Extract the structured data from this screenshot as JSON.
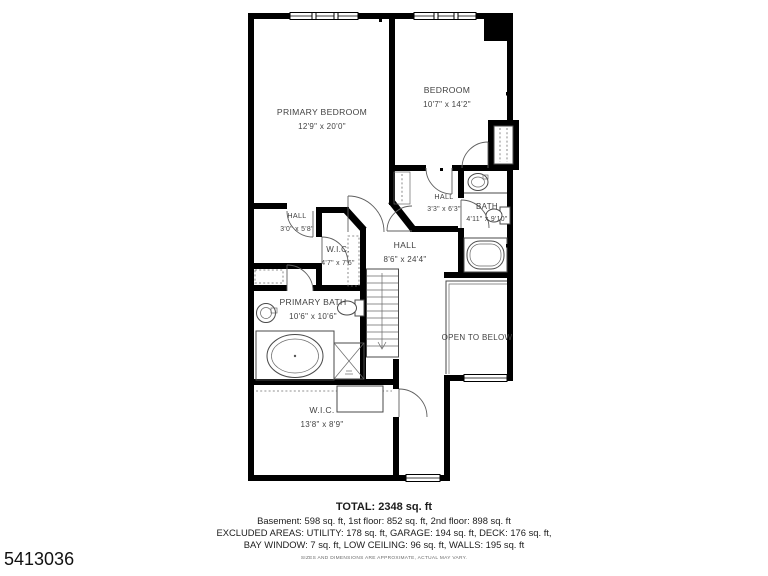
{
  "listing_id": "5413036",
  "plan": {
    "wall_color": "#000000",
    "rooms": [
      {
        "name": "PRIMARY BEDROOM",
        "dims": "12'9\" x 20'0\""
      },
      {
        "name": "BEDROOM",
        "dims": "10'7\" x 14'2\""
      },
      {
        "name": "HALL",
        "dims": "3'3\" x 6'3\""
      },
      {
        "name": "BATH",
        "dims": "4'11\" x 9'10\""
      },
      {
        "name": "HALL",
        "dims": "8'6\" x 24'4\""
      },
      {
        "name": "HALL",
        "dims": "3'0\" x 5'8\""
      },
      {
        "name": "W.I.C.",
        "dims": "4'7\" x 7'6\""
      },
      {
        "name": "PRIMARY BATH",
        "dims": "10'6\" x 10'6\""
      },
      {
        "name": "OPEN TO BELOW",
        "dims": ""
      },
      {
        "name": "W.I.C.",
        "dims": "13'8\" x 8'9\""
      }
    ]
  },
  "footer": {
    "total": "TOTAL: 2348 sq. ft",
    "line1": "Basement: 598 sq. ft, 1st floor: 852 sq. ft, 2nd floor: 898 sq. ft",
    "line2": "EXCLUDED AREAS: UTILITY: 178 sq. ft, GARAGE: 194 sq. ft, DECK: 176 sq. ft,",
    "line3": "BAY WINDOW: 7 sq. ft, LOW CEILING: 96 sq. ft, WALLS: 195 sq. ft",
    "disclaimer": "SIZES AND DIMENSIONS ARE APPROXIMATE, ACTUAL MAY VARY."
  }
}
